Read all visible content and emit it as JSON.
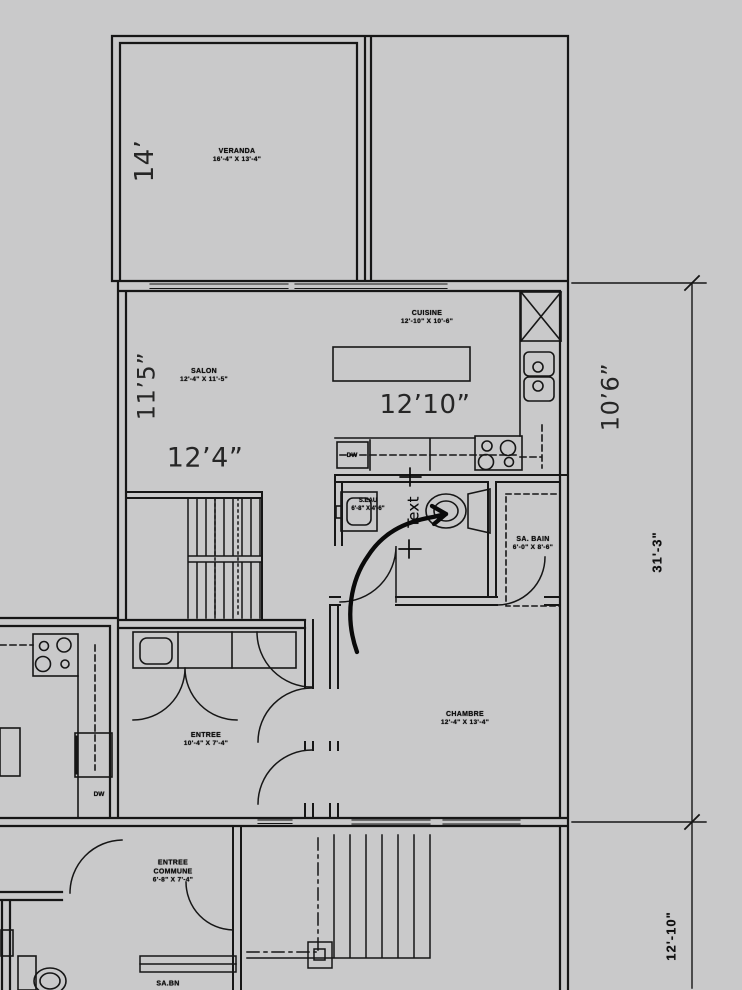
{
  "annotations": {
    "d14": "14’",
    "d11_5": "11’5”",
    "d12_4": "12’4”",
    "d12_10": "12’10”",
    "d10_6": "10’6”",
    "d31_3": "31'-3\"",
    "d12_10_low": "12'-10\"",
    "text_note": "Text"
  },
  "rooms": {
    "veranda": {
      "name": "VERANDA",
      "size": "16'-4\" X 13'-4\""
    },
    "salon": {
      "name": "SALON",
      "size": "12'-4\" X 11'-5\""
    },
    "cuisine": {
      "name": "CUISINE",
      "size": "12'-10\" X 10'-6\""
    },
    "sa_bain": {
      "name": "SA. BAIN",
      "size": "6'-0\" X 8'-6\""
    },
    "chambre": {
      "name": "CHAMBRE",
      "size": "12'-4\" X 13'-4\""
    },
    "entree": {
      "name": "ENTREE",
      "size": "10'-4\" X 7'-4\""
    },
    "entree_commune": {
      "line1": "ENTREE",
      "line2": "COMMUNE",
      "size": "6'-8\" X 7'-4\""
    },
    "s_eau": {
      "name": "S.EAU",
      "size": "6'-8\" X 4'-6\""
    },
    "sa_bn": {
      "name": "SA.BN"
    }
  },
  "fixtures": {
    "dishwasher_main": "DW",
    "dishwasher_left": "DW"
  },
  "colors": {
    "background": "#c9c9ca",
    "line": "#161616",
    "annotation": "#262626"
  }
}
